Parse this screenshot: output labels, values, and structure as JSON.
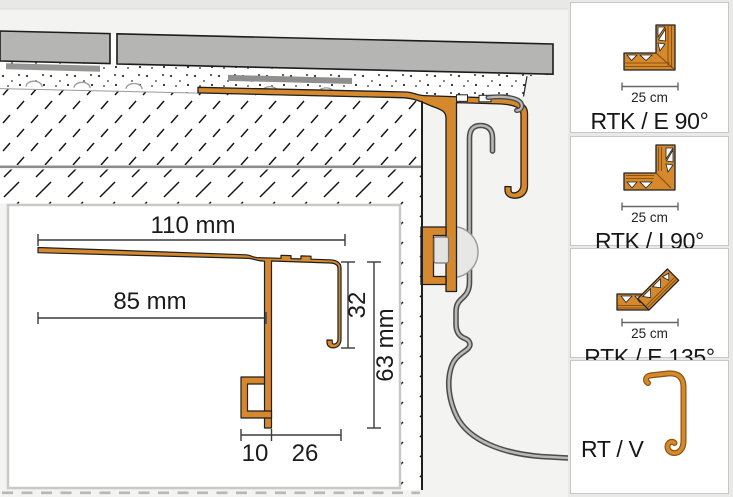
{
  "diagram": {
    "title": "balcony-edge-profile-cross-section",
    "inset": {
      "dims": {
        "top_width": "110 mm",
        "upper_width": "85 mm",
        "face_height": "32",
        "total_height": "63 mm",
        "bracket_width": "10",
        "overhang": "26"
      }
    }
  },
  "sidebar": {
    "items": [
      {
        "label": "RTK / E 90°",
        "size": "25 cm",
        "icon": "outside-corner-90-icon"
      },
      {
        "label": "RTK / I 90°",
        "size": "25 cm",
        "icon": "inside-corner-90-icon"
      },
      {
        "label": "RTK / E 135°",
        "size": "25 cm",
        "icon": "outside-corner-135-icon"
      },
      {
        "label": "RT / V",
        "size": "",
        "icon": "vertical-profile-icon"
      }
    ]
  },
  "colors": {
    "profile_orange": "#D5882C",
    "steel_gray": "#9a9a9a",
    "tile_gray": "#b5b5b4",
    "background": "#f3f3f2"
  }
}
